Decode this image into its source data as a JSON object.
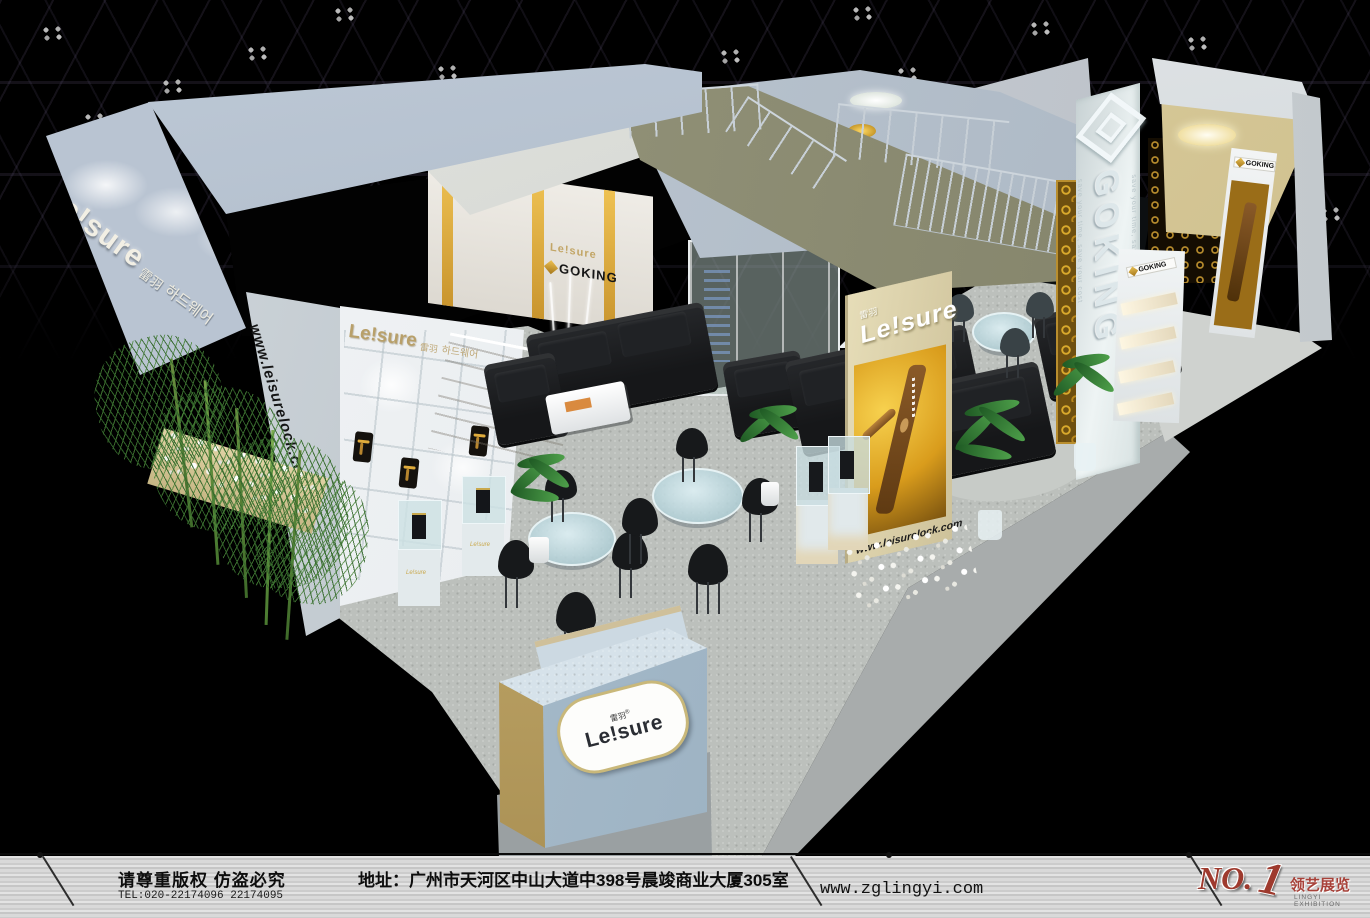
{
  "scene": {
    "description": "3D rendering of an island exhibition booth for lock brands Leisure and GOKING inside a dark exhibition hall",
    "hall": "black truss ceiling with clustered spotlights"
  },
  "branding": {
    "leisure_logo": "Le!sure",
    "leisure_cn": "雷羽",
    "leisure_kr": "하드웨어",
    "leisure_reg": "®",
    "leisure_site": "www.leisurelock.com",
    "goking_logo": "GOKING",
    "goking_tagline": "save your time, save your cost"
  },
  "footer": {
    "copyright": "请尊重版权 仿盗必究",
    "tel": "TEL:020-22174096 22174095",
    "address": "地址：广州市天河区中山大道中398号晨竣商业大厦305室",
    "website": "www.zglingyi.com",
    "logo_no": "NO.",
    "logo_one": "1",
    "company_cn": "领艺展览",
    "company_en": "LINGYI EXHIBITION"
  },
  "colors": {
    "booth_panel": "#aeb9c6",
    "accent_gold": "#d8a93c",
    "beige_column": "#d8cca0",
    "carpet": "#bcc0bc",
    "sofa_black": "#1b1d1f"
  }
}
